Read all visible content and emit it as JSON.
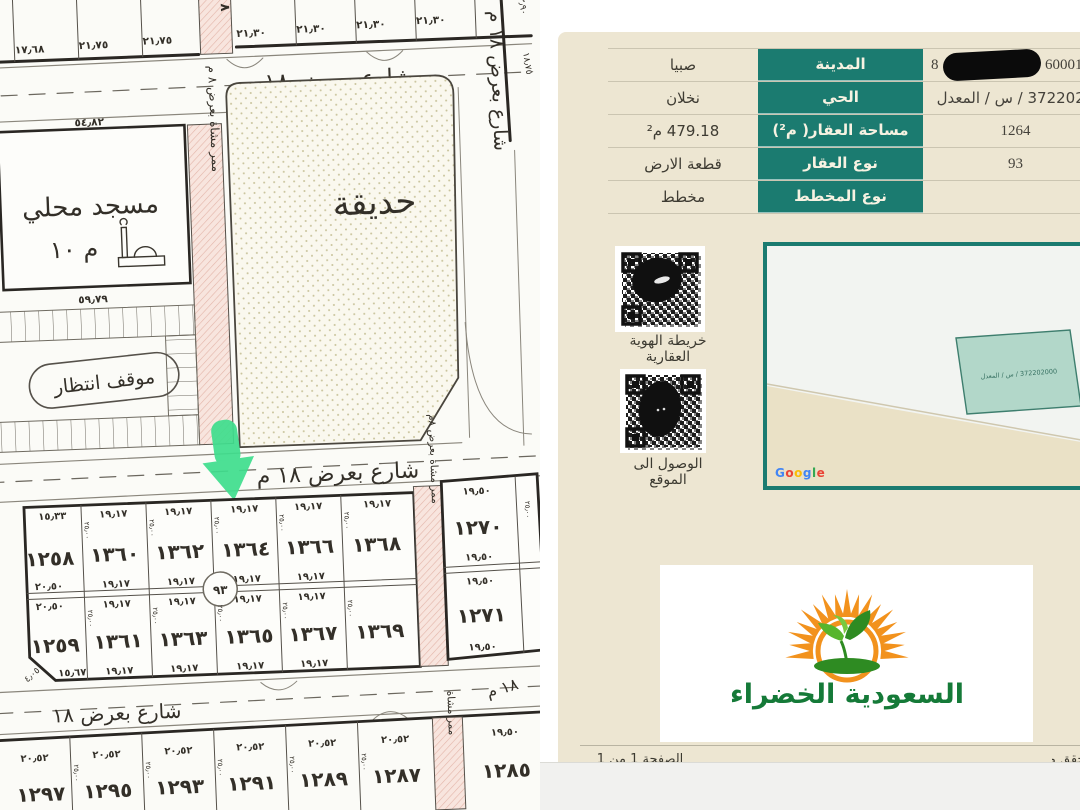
{
  "left_map": {
    "streets": {
      "top": "شارع بعرض ١٨ م",
      "right": "شارع بعرض ١٨ م",
      "middle": "شارع بعرض ١٨ م",
      "bottom": "شارع بعرض ١٨",
      "bottom_right": "١٨ م"
    },
    "passages": {
      "top": "٨ م",
      "mosque_park": "ممر مشاة بعرض ٨ م",
      "block": "ممر مشاة بعرض ٨م",
      "bottom": "ممر مشاة"
    },
    "mosque": {
      "label": "مسجد محلي",
      "number": "م ١٠",
      "top_dim": "٥٤٫٨٢",
      "bottom_dim": "٥٩٫٧٩"
    },
    "park_label": "حديقة",
    "parking_label": "موقف انتظار",
    "block_circle": "٩٣",
    "top_left_dims": [
      "١٧٫٦٨",
      "٢١٫٧٥",
      "٢١٫٧٥"
    ],
    "top_right_dims": [
      "٢١٫٣٠",
      "٢١٫٣٠",
      "٢١٫٣٠",
      "٢١٫٣٠"
    ],
    "right_edge_dims": [
      "١٣٫٩٠",
      "١٨٫٧٥"
    ],
    "row1_plots": [
      "١٢٥٨",
      "١٣٦٠",
      "١٣٦٢",
      "١٣٦٤",
      "١٣٦٦",
      "١٣٦٨"
    ],
    "row2_plots": [
      "١٢٥٩",
      "١٣٦١",
      "١٣٦٣",
      "١٣٦٥",
      "١٣٦٧",
      "١٣٦٩"
    ],
    "right_plots": [
      "١٢٧٠",
      "١٢٧١"
    ],
    "bottom_plots": [
      "١٢٩٧",
      "١٢٩٥",
      "١٢٩٣",
      "١٢٩١",
      "١٢٨٩",
      "١٢٨٧",
      "١٢٨٥"
    ],
    "dim_plot": "١٩٫١٧",
    "dim_right": "١٩٫٥٠",
    "dim_bottom": "٢٠٫٥٢",
    "dim_depth": "٢٥٫٠٠",
    "dim_first_top": "١٥٫٣٣",
    "dim_first_side": "٢٠٫٥٠",
    "dim_first_bottom": "١٥٫٦٧",
    "dim_chamfer": "٤٫٠٥",
    "edge_plot": "١٣٩٧"
  },
  "document": {
    "table_rows": [
      {
        "label": "المدينة",
        "value": "صبيا",
        "ref_prefix": "8",
        "ref_suffix": "60001"
      },
      {
        "label": "الحي",
        "value": "نخلان",
        "ref": "372202000 / س / المعدل"
      },
      {
        "label": "مساحة العقار( م²)",
        "value": "479.18 م²",
        "ref": "1264"
      },
      {
        "label": "نوع العقار",
        "value": "قطعة الارض",
        "ref": "93"
      },
      {
        "label": "نوع المخطط",
        "value": "مخطط",
        "ref": ""
      }
    ],
    "qr_map_label": "خريطة الهوية العقارية",
    "qr_location_label": "الوصول الى الموقع",
    "minimap": {
      "parcel_label": "372202000 / س / المعدل",
      "google_letters": [
        "G",
        "o",
        "o",
        "g",
        "l",
        "e"
      ]
    },
    "footer": {
      "page": "الصفحة 1 من 1",
      "verify_fragment": "للتحقق من صحة"
    },
    "logo_text": "السعودية الخضراء"
  },
  "colors": {
    "teal": "#1B7B70",
    "page_beige": "#EDE6D2",
    "arrow_green": "#3FDE8D",
    "passage_pink": "#F8E5DE",
    "logo_orange": "#F2921D",
    "logo_green": "#157A38"
  }
}
